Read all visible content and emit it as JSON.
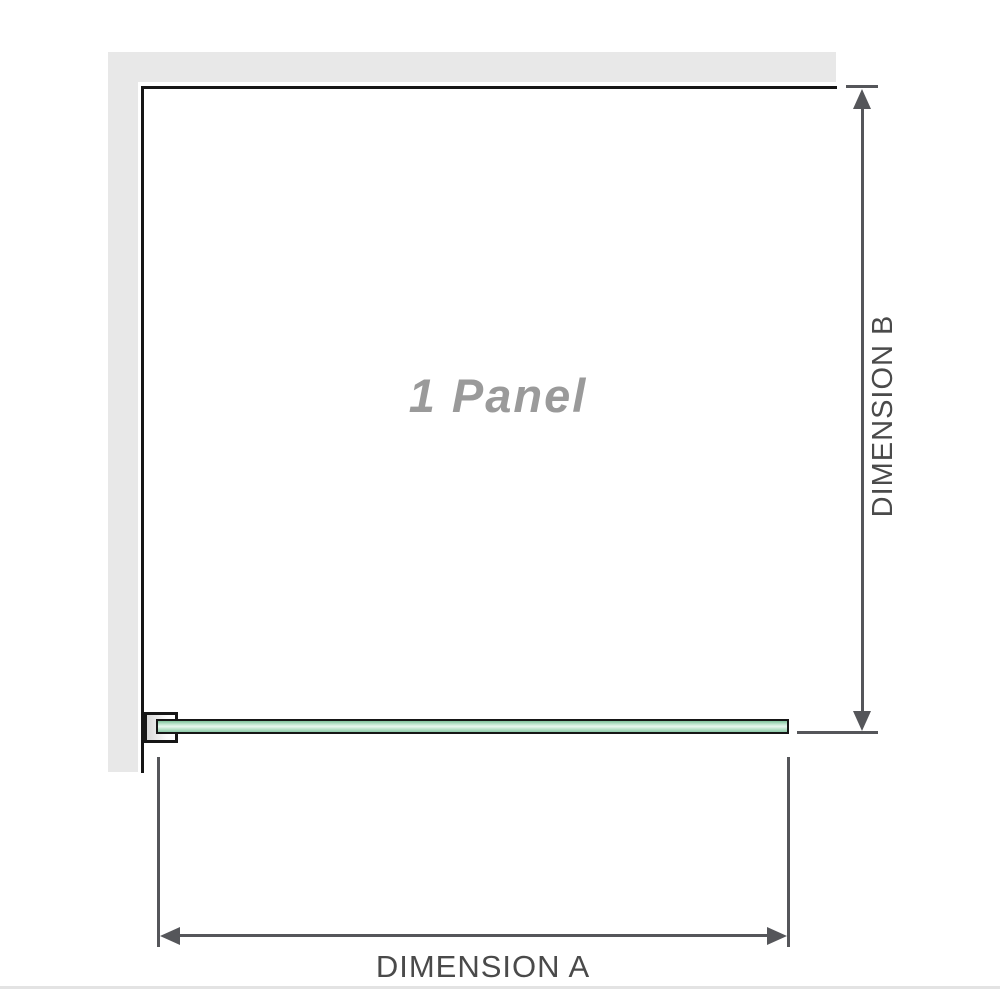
{
  "diagram": {
    "panel_label": "1 Panel",
    "dimension_a": {
      "label": "DIMENSION A"
    },
    "dimension_b": {
      "label": "DIMENSION B"
    }
  },
  "colors": {
    "wall_fill": "#e8e8e8",
    "outline": "#161616",
    "dimension_line": "#55565a",
    "dimension_text": "#4a4a4a",
    "panel_label_text": "#9a9a9a",
    "glass_green_dark": "#7fc29c",
    "glass_green_light": "#e9f7ef",
    "base_line": "#e3e3e3"
  }
}
